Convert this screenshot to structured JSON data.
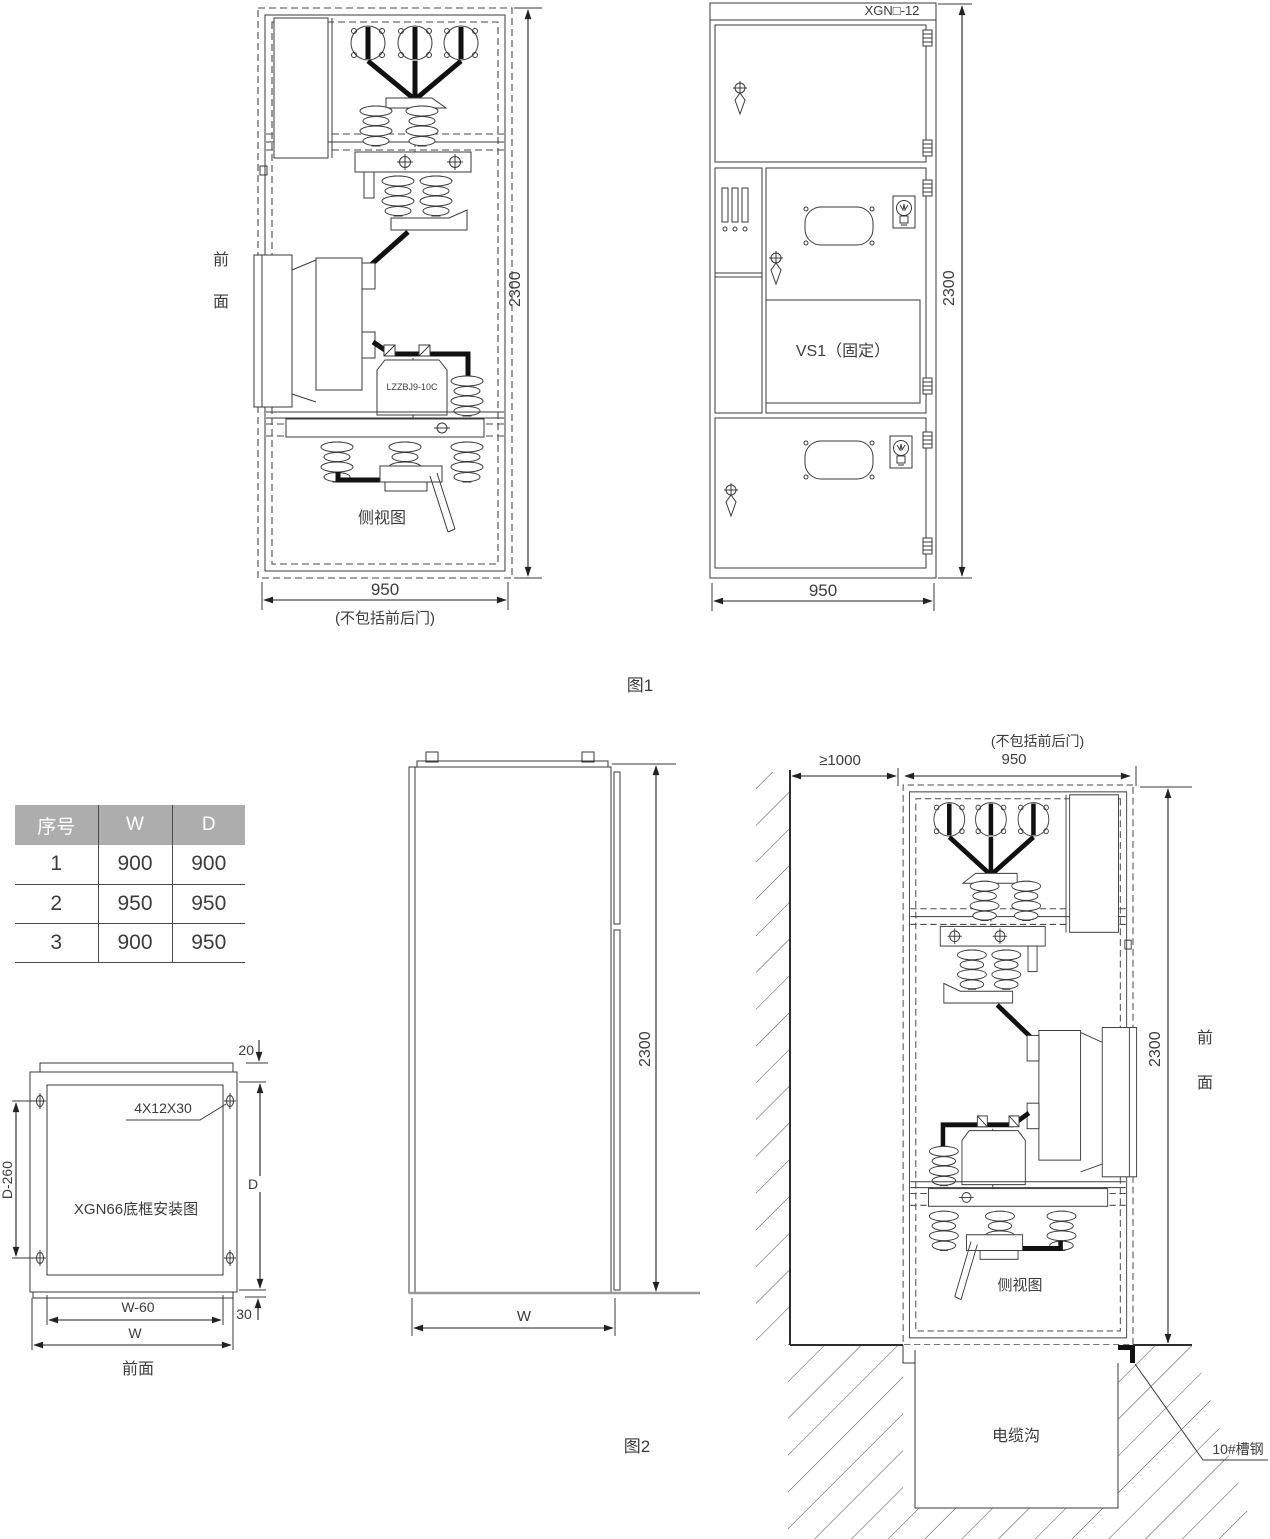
{
  "page": {
    "background": "#ffffff",
    "line_color": "#3a3a3a",
    "busbar_color": "#111111",
    "table_header_bg": "#adadad",
    "floor_line_color": "#999999"
  },
  "figure1": {
    "caption": "图1",
    "side_view": {
      "front_label_top": "前",
      "front_label_bottom": "面",
      "view_label": "侧视图",
      "ct_model": "LZZBJ9-10C",
      "height_dim": "2300",
      "width_dim": "950",
      "width_note": "(不包括前后门)"
    },
    "front_view": {
      "model": "XGN□-12",
      "breaker_label": "VS1（固定）",
      "height_dim": "2300",
      "width_dim": "950"
    }
  },
  "size_table": {
    "headers": [
      "序号",
      "W",
      "D"
    ],
    "rows": [
      [
        "1",
        "900",
        "900"
      ],
      [
        "2",
        "950",
        "950"
      ],
      [
        "3",
        "900",
        "950"
      ]
    ]
  },
  "base_frame": {
    "title": "XGN66底框安装图",
    "bolt_spec": "4X12X30",
    "top_dim": "20",
    "left_dim": "D-260",
    "right_dim": "D",
    "inner_width_dim": "W-60",
    "width_dim": "W",
    "bottom_right_dim": "30",
    "front_label": "前面"
  },
  "figure2": {
    "caption": "图2",
    "blank_cabinet": {
      "height_dim": "2300",
      "width_dim": "W"
    },
    "installation": {
      "wall_clearance_dim": "≥1000",
      "width_dim": "950",
      "width_note": "(不包括前后门)",
      "height_dim": "2300",
      "front_label_top": "前",
      "front_label_bottom": "面",
      "view_label": "侧视图",
      "cable_trench_label": "电缆沟",
      "channel_steel_label": "10#槽钢"
    }
  }
}
